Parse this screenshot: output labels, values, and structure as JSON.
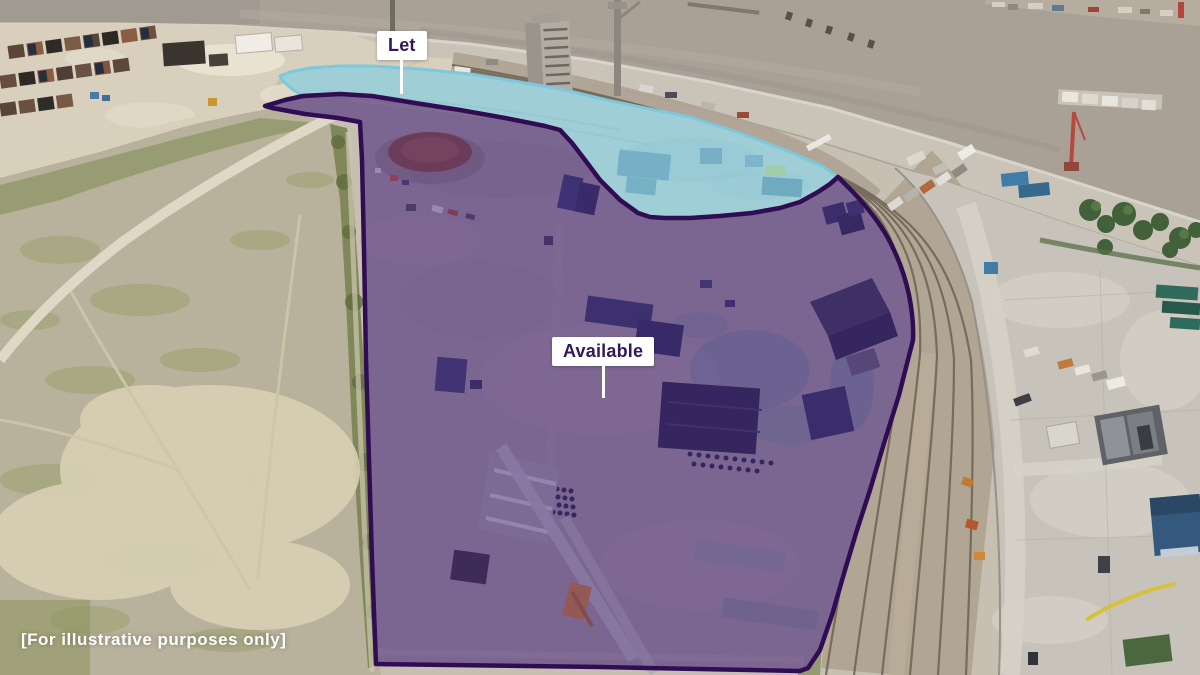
{
  "regions": [
    {
      "id": "let",
      "label": "Let",
      "fill": "rgba(136,216,240,0.60)",
      "border": "#7cc8dd"
    },
    {
      "id": "available",
      "label": "Available",
      "fill": "rgba(86,45,134,0.45)",
      "border": "#300d52"
    }
  ],
  "disclaimer": "[For illustrative purposes only]",
  "colors": {
    "label_bg": "#ffffff",
    "label_text": "#32175a",
    "pointer_line": "#ffffff",
    "disclaimer_text": "#ffffff"
  }
}
